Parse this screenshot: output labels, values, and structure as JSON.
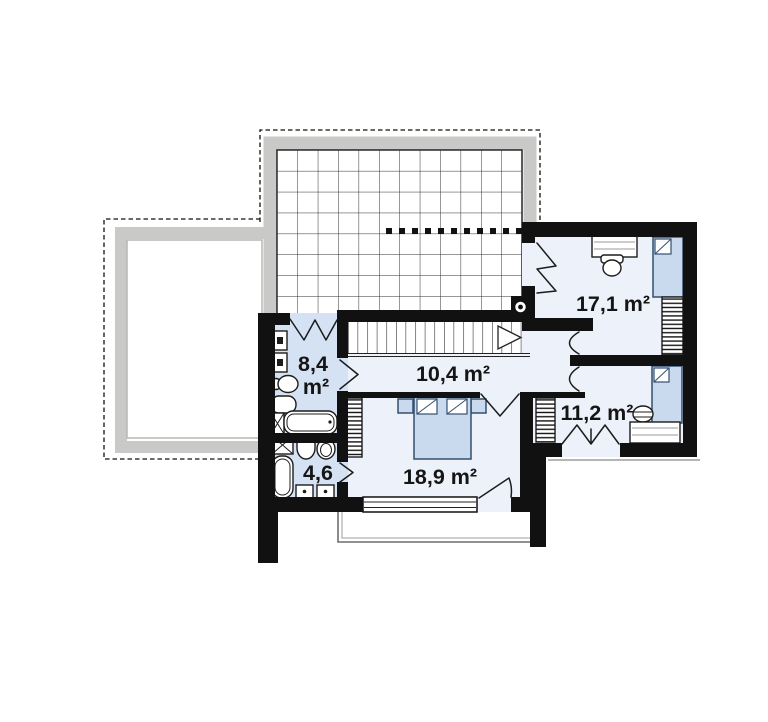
{
  "page": {
    "background": "#ffffff",
    "kind": "architectural floor plan, upper storey"
  },
  "colors": {
    "wall": "#111111",
    "room_light": "#edf1f9",
    "bath_blue": "#d5e2f3",
    "furniture_blue": "#c9d9ee",
    "furniture_outline": "#33506f",
    "roof_band": "#c9c9c7",
    "line": "#1c1c1c",
    "text": "#151515",
    "balcony": "#6f6f6f"
  },
  "rooms": {
    "bathroom_upper": {
      "area": "8,4",
      "unit": "m²"
    },
    "hallway": {
      "area": "10,4 m²"
    },
    "bedroom_top_right": {
      "area": "17,1 m²"
    },
    "bedroom_bottom_right": {
      "area": "11,2 m²"
    },
    "bathroom_lower": {
      "area": "4,6"
    },
    "bedroom_master": {
      "area": "18,9 m²"
    }
  }
}
